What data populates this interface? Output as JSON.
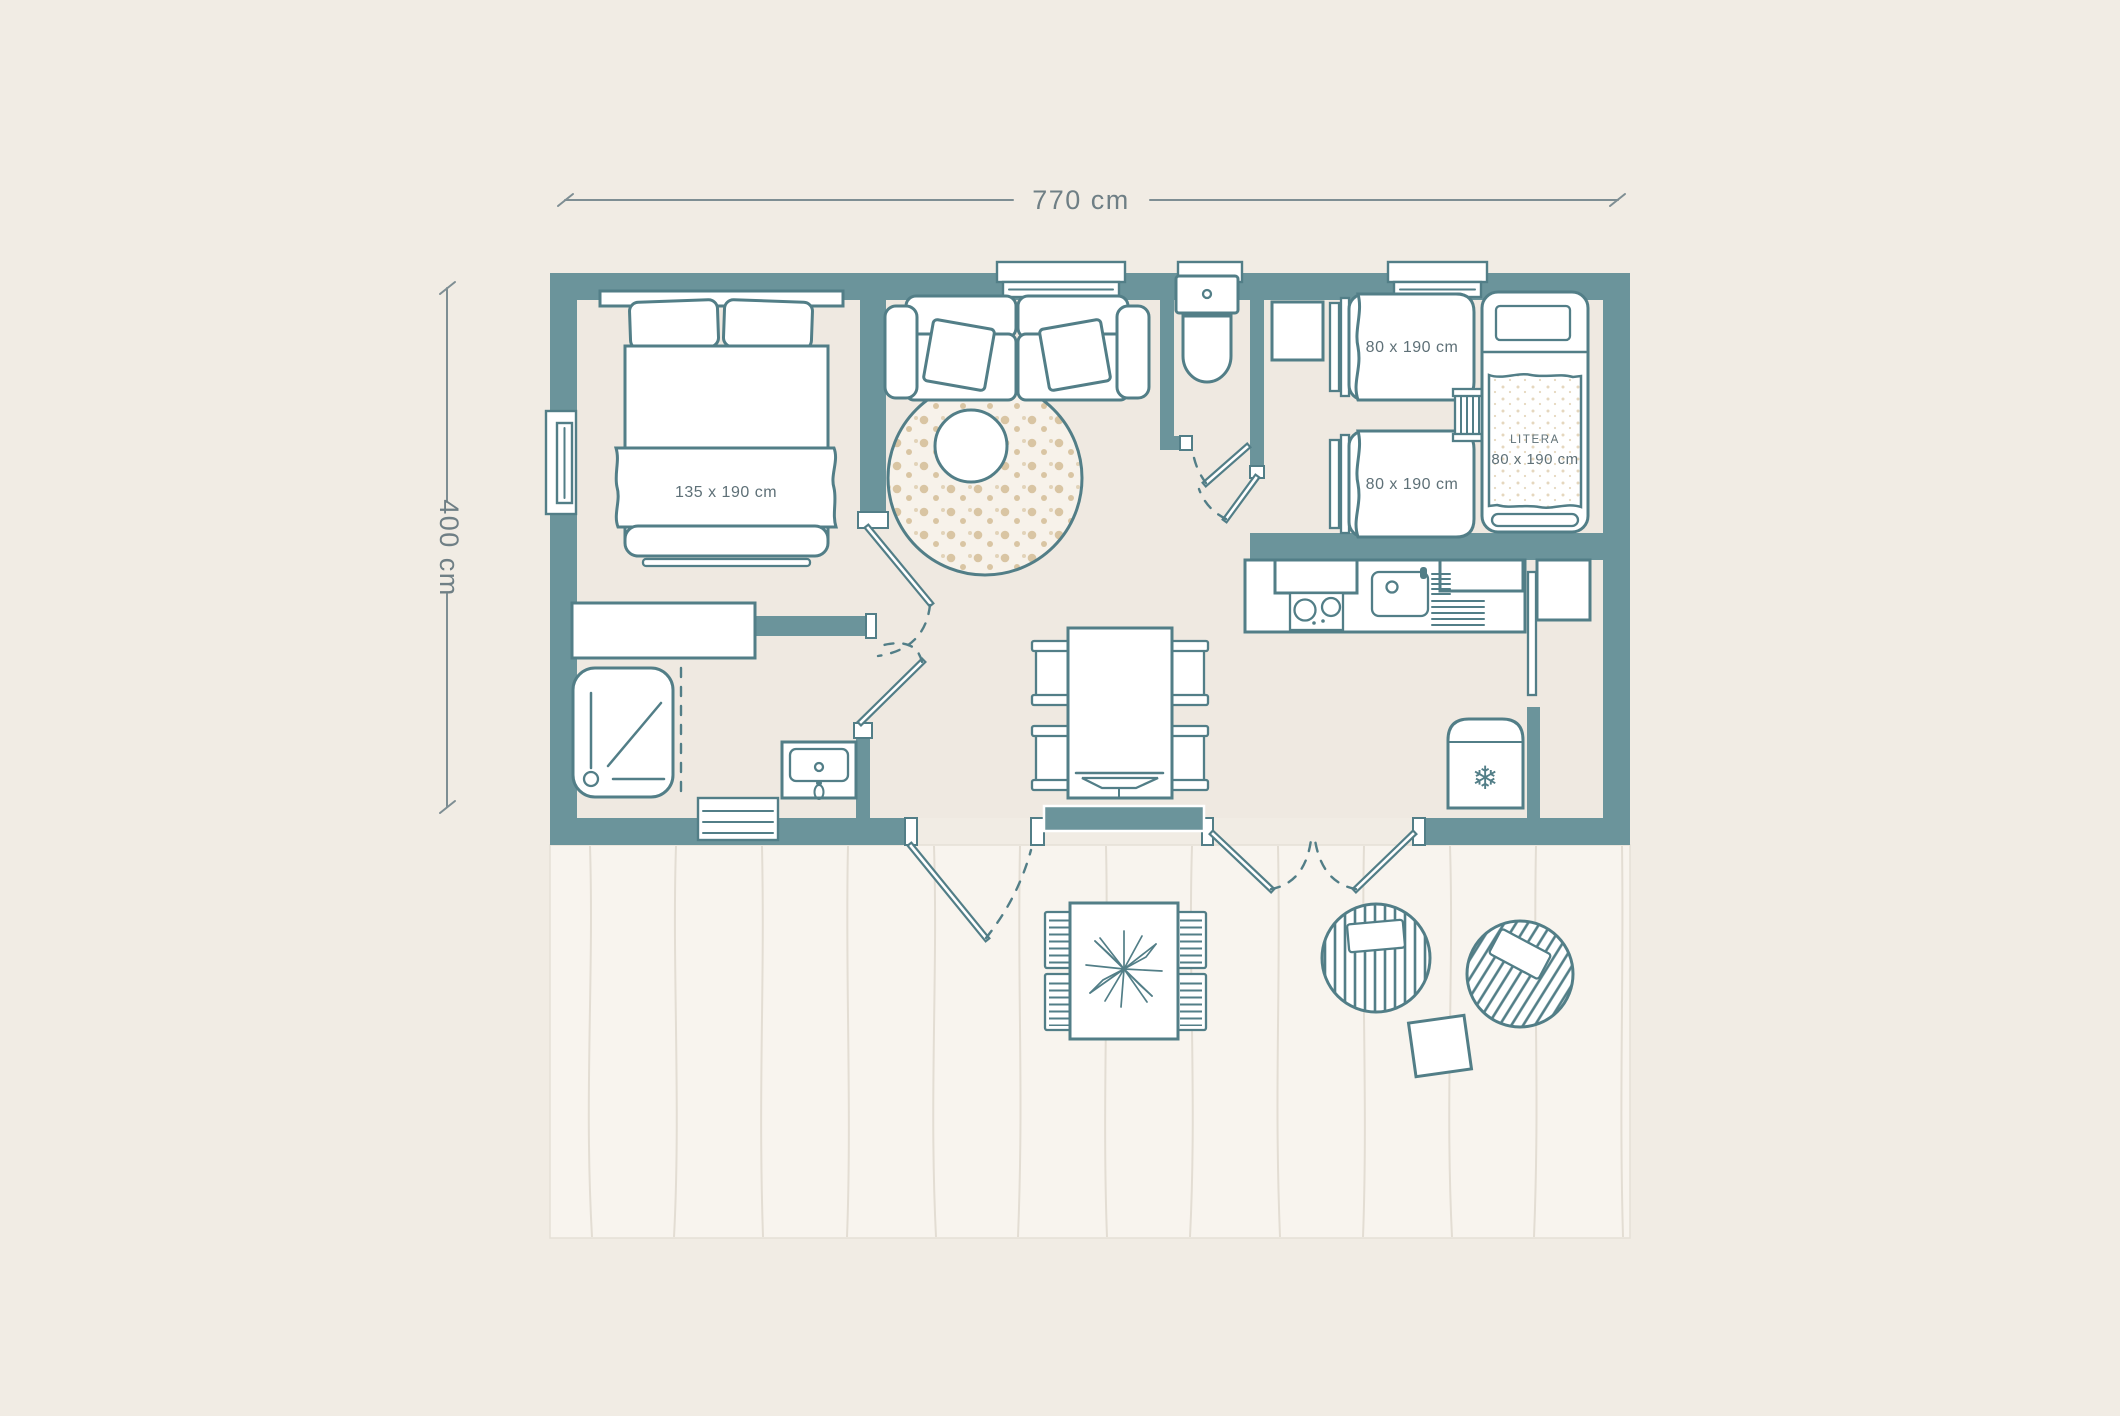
{
  "colors": {
    "page_background": "#F1ECE4",
    "wall": "#6B949B",
    "outline": "#527E87",
    "floor": "#EFE9E1",
    "terrace": "#F8F4EE",
    "dots_tan": "#D9C5A3",
    "dimension_text": "#6F7F85",
    "label_text": "#5E7077"
  },
  "dimensions": {
    "width_label": "770 cm",
    "height_label": "400 cm"
  },
  "labels": {
    "master_bed": "135 x 190 cm",
    "single_bed_top": "80 x 190 cm",
    "single_bed_bottom": "80 x 190 cm",
    "bunk_bed_line1": "LITERA",
    "bunk_bed_line2": "80 x 190 cm"
  },
  "icons": {
    "fridge_snowflake": "❄"
  }
}
